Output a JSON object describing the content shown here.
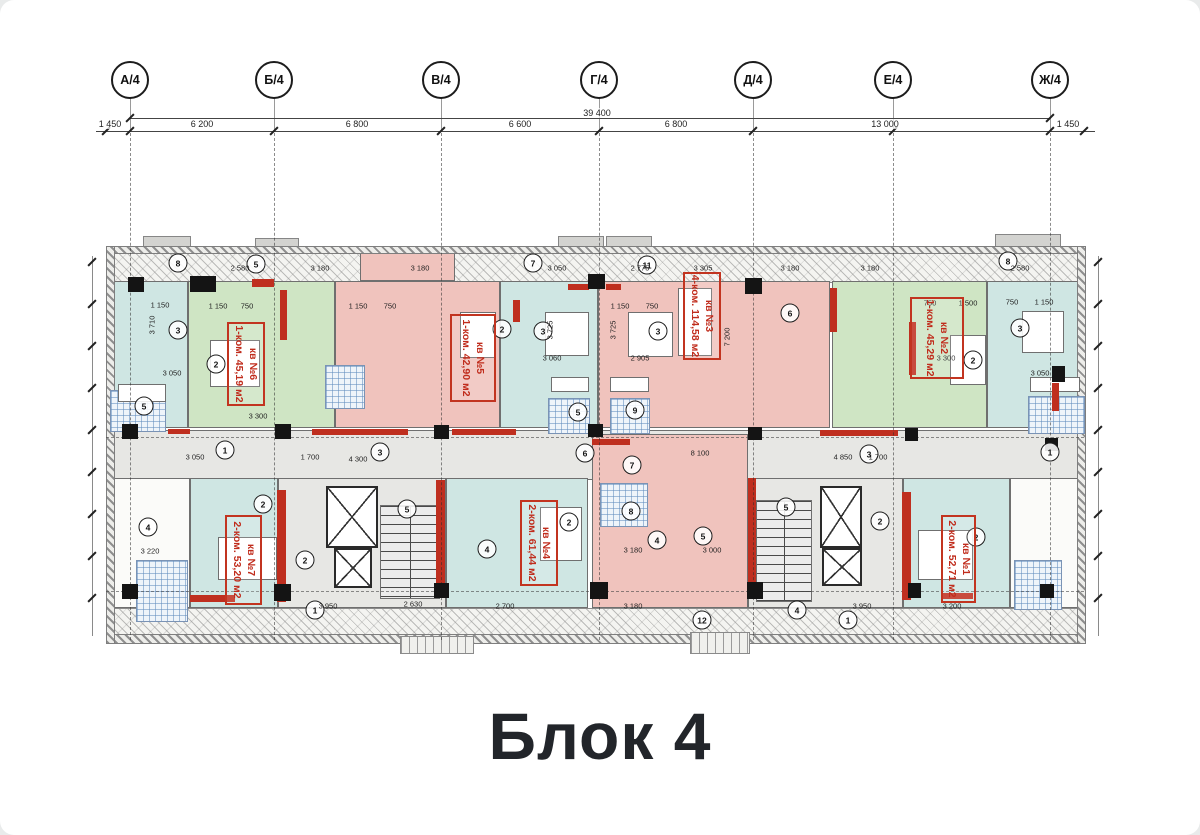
{
  "title": {
    "text": "Блок 4"
  },
  "palette": {
    "green": "#cfe5c4",
    "pink": "#f0c3bd",
    "cyan": "#cfe6e3",
    "gray": "#e7e7e4",
    "white": "#fbfbf9",
    "red": "#bf2f1f",
    "black": "#141414"
  },
  "axes": {
    "circle_y": 80,
    "line_top": 98,
    "line_bottom": 640,
    "items": [
      {
        "label": "А/4",
        "x": 130
      },
      {
        "label": "Б/4",
        "x": 274
      },
      {
        "label": "В/4",
        "x": 441
      },
      {
        "label": "Г/4",
        "x": 599
      },
      {
        "label": "Д/4",
        "x": 753
      },
      {
        "label": "Е/4",
        "x": 893
      },
      {
        "label": "Ж/4",
        "x": 1050
      }
    ]
  },
  "dimensions": {
    "total": {
      "label": "39 400",
      "x": 597,
      "y": 112,
      "x1": 130,
      "x2": 1050,
      "line_y": 118
    },
    "row_y": 131,
    "row_x1": 96,
    "row_x2": 1095,
    "ticks": [
      106,
      130,
      274,
      441,
      599,
      753,
      893,
      1050,
      1084
    ],
    "labels": [
      {
        "text": "1 450",
        "x": 110
      },
      {
        "text": "6 200",
        "x": 202
      },
      {
        "text": "6 800",
        "x": 357
      },
      {
        "text": "6 600",
        "x": 520
      },
      {
        "text": "6 800",
        "x": 676
      },
      {
        "text": "13 000",
        "x": 885
      },
      {
        "text": "1 450",
        "x": 1068
      }
    ]
  },
  "plan": {
    "walls": [
      {
        "x": 106,
        "y": 246,
        "w": 978,
        "h": 6
      },
      {
        "x": 106,
        "y": 634,
        "w": 978,
        "h": 8
      },
      {
        "x": 106,
        "y": 246,
        "w": 7,
        "h": 396
      },
      {
        "x": 1077,
        "y": 246,
        "w": 7,
        "h": 396
      }
    ],
    "strips": [
      {
        "x": 112,
        "y": 250,
        "w": 966,
        "h": 31
      },
      {
        "x": 112,
        "y": 608,
        "w": 966,
        "h": 28
      }
    ],
    "protrusions": [
      {
        "x": 143,
        "y": 236,
        "w": 46,
        "h": 11
      },
      {
        "x": 255,
        "y": 238,
        "w": 42,
        "h": 9
      },
      {
        "x": 558,
        "y": 236,
        "w": 44,
        "h": 11
      },
      {
        "x": 606,
        "y": 236,
        "w": 44,
        "h": 11
      },
      {
        "x": 995,
        "y": 234,
        "w": 64,
        "h": 13
      }
    ],
    "corridor": {
      "x": 112,
      "y": 430,
      "w": 966,
      "h": 50
    },
    "regions": [
      {
        "name": "room-end-left",
        "color": "cyan",
        "x": 112,
        "y": 281,
        "w": 76,
        "h": 147
      },
      {
        "name": "apt-6-area",
        "color": "green",
        "x": 188,
        "y": 281,
        "w": 147,
        "h": 147
      },
      {
        "name": "apt-5-balcony",
        "color": "pink",
        "x": 360,
        "y": 252,
        "w": 95,
        "h": 29
      },
      {
        "name": "apt-5-area",
        "color": "pink",
        "x": 335,
        "y": 281,
        "w": 165,
        "h": 147
      },
      {
        "name": "room-mid-cyan",
        "color": "cyan",
        "x": 500,
        "y": 281,
        "w": 98,
        "h": 147
      },
      {
        "name": "apt-3-area",
        "color": "pink",
        "x": 598,
        "y": 281,
        "w": 232,
        "h": 147
      },
      {
        "name": "apt-2-area",
        "color": "green",
        "x": 832,
        "y": 281,
        "w": 155,
        "h": 147
      },
      {
        "name": "room-end-right",
        "color": "cyan",
        "x": 987,
        "y": 281,
        "w": 97,
        "h": 147
      },
      {
        "name": "room-left-bottom",
        "color": "white",
        "x": 112,
        "y": 478,
        "w": 78,
        "h": 130
      },
      {
        "name": "apt-7-area",
        "color": "cyan",
        "x": 190,
        "y": 478,
        "w": 88,
        "h": 130
      },
      {
        "name": "core-left",
        "color": "gray",
        "x": 278,
        "y": 478,
        "w": 168,
        "h": 130
      },
      {
        "name": "apt-4-area",
        "color": "cyan",
        "x": 446,
        "y": 478,
        "w": 142,
        "h": 130
      },
      {
        "name": "apt-3-lower-area",
        "color": "pink",
        "x": 592,
        "y": 434,
        "w": 156,
        "h": 174
      },
      {
        "name": "core-right",
        "color": "gray",
        "x": 748,
        "y": 478,
        "w": 155,
        "h": 130
      },
      {
        "name": "apt-1-area",
        "color": "cyan",
        "x": 903,
        "y": 478,
        "w": 107,
        "h": 130
      },
      {
        "name": "room-right-bottom",
        "color": "white",
        "x": 1010,
        "y": 478,
        "w": 74,
        "h": 130
      }
    ],
    "bath_tiles": [
      {
        "x": 110,
        "y": 390,
        "w": 54,
        "h": 40
      },
      {
        "x": 325,
        "y": 365,
        "w": 38,
        "h": 42
      },
      {
        "x": 548,
        "y": 398,
        "w": 40,
        "h": 34
      },
      {
        "x": 610,
        "y": 398,
        "w": 38,
        "h": 34
      },
      {
        "x": 1028,
        "y": 396,
        "w": 55,
        "h": 36
      },
      {
        "x": 600,
        "y": 483,
        "w": 46,
        "h": 42
      },
      {
        "x": 136,
        "y": 560,
        "w": 50,
        "h": 60
      },
      {
        "x": 1014,
        "y": 560,
        "w": 46,
        "h": 48
      }
    ],
    "elevators": [
      {
        "x": 326,
        "y": 486,
        "w": 48,
        "h": 58
      },
      {
        "x": 334,
        "y": 548,
        "w": 34,
        "h": 36
      },
      {
        "x": 820,
        "y": 486,
        "w": 38,
        "h": 58
      },
      {
        "x": 822,
        "y": 548,
        "w": 36,
        "h": 34
      }
    ],
    "stairs": [
      {
        "x": 380,
        "y": 505,
        "w": 58,
        "h": 92
      },
      {
        "x": 756,
        "y": 500,
        "w": 54,
        "h": 100
      }
    ],
    "columns": [
      [
        190,
        276,
        26,
        16
      ],
      [
        128,
        277,
        16,
        15
      ],
      [
        588,
        274,
        17,
        15
      ],
      [
        745,
        278,
        17,
        16
      ],
      [
        1052,
        366,
        13,
        16
      ],
      [
        122,
        424,
        16,
        15
      ],
      [
        275,
        424,
        16,
        15
      ],
      [
        434,
        425,
        15,
        14
      ],
      [
        588,
        424,
        15,
        13
      ],
      [
        748,
        427,
        14,
        13
      ],
      [
        905,
        428,
        13,
        13
      ],
      [
        1045,
        438,
        13,
        13
      ],
      [
        122,
        584,
        16,
        15
      ],
      [
        274,
        584,
        17,
        17
      ],
      [
        434,
        583,
        15,
        15
      ],
      [
        590,
        582,
        18,
        17
      ],
      [
        747,
        582,
        16,
        17
      ],
      [
        908,
        583,
        13,
        15
      ],
      [
        1040,
        584,
        14,
        14
      ]
    ],
    "red_walls": [
      [
        252,
        279,
        22,
        8
      ],
      [
        568,
        284,
        21,
        6
      ],
      [
        606,
        284,
        15,
        6
      ],
      [
        830,
        288,
        7,
        44
      ],
      [
        513,
        300,
        7,
        22
      ],
      [
        280,
        290,
        7,
        50
      ],
      [
        909,
        322,
        7,
        53
      ],
      [
        168,
        429,
        22,
        5
      ],
      [
        312,
        429,
        96,
        6
      ],
      [
        452,
        429,
        64,
        6
      ],
      [
        820,
        430,
        78,
        6
      ],
      [
        592,
        439,
        38,
        6
      ],
      [
        436,
        480,
        9,
        103
      ],
      [
        748,
        478,
        8,
        109
      ],
      [
        277,
        490,
        9,
        112
      ],
      [
        902,
        492,
        9,
        108
      ],
      [
        1052,
        383,
        7,
        28
      ],
      [
        190,
        595,
        45,
        7
      ],
      [
        941,
        593,
        32,
        6
      ]
    ],
    "circles": [
      {
        "n": "8",
        "x": 178,
        "y": 263
      },
      {
        "n": "5",
        "x": 256,
        "y": 264
      },
      {
        "n": "7",
        "x": 533,
        "y": 263
      },
      {
        "n": "11",
        "x": 647,
        "y": 265
      },
      {
        "n": "8",
        "x": 1008,
        "y": 261
      },
      {
        "n": "3",
        "x": 178,
        "y": 330
      },
      {
        "n": "2",
        "x": 216,
        "y": 364
      },
      {
        "n": "2",
        "x": 502,
        "y": 329
      },
      {
        "n": "3",
        "x": 543,
        "y": 331
      },
      {
        "n": "3",
        "x": 658,
        "y": 331
      },
      {
        "n": "6",
        "x": 790,
        "y": 313
      },
      {
        "n": "2",
        "x": 973,
        "y": 360
      },
      {
        "n": "3",
        "x": 1020,
        "y": 328
      },
      {
        "n": "5",
        "x": 144,
        "y": 406
      },
      {
        "n": "5",
        "x": 578,
        "y": 412
      },
      {
        "n": "9",
        "x": 635,
        "y": 410
      },
      {
        "n": "1",
        "x": 225,
        "y": 450
      },
      {
        "n": "3",
        "x": 380,
        "y": 452
      },
      {
        "n": "6",
        "x": 585,
        "y": 453
      },
      {
        "n": "7",
        "x": 632,
        "y": 465
      },
      {
        "n": "3",
        "x": 869,
        "y": 454
      },
      {
        "n": "1",
        "x": 1050,
        "y": 452
      },
      {
        "n": "2",
        "x": 263,
        "y": 504
      },
      {
        "n": "4",
        "x": 148,
        "y": 527
      },
      {
        "n": "5",
        "x": 407,
        "y": 509
      },
      {
        "n": "2",
        "x": 305,
        "y": 560
      },
      {
        "n": "1",
        "x": 315,
        "y": 610
      },
      {
        "n": "4",
        "x": 487,
        "y": 549
      },
      {
        "n": "2",
        "x": 569,
        "y": 522
      },
      {
        "n": "8",
        "x": 631,
        "y": 511
      },
      {
        "n": "4",
        "x": 657,
        "y": 540
      },
      {
        "n": "5",
        "x": 703,
        "y": 536
      },
      {
        "n": "12",
        "x": 702,
        "y": 620
      },
      {
        "n": "5",
        "x": 786,
        "y": 507
      },
      {
        "n": "4",
        "x": 797,
        "y": 610
      },
      {
        "n": "1",
        "x": 848,
        "y": 620
      },
      {
        "n": "2",
        "x": 880,
        "y": 521
      },
      {
        "n": "2",
        "x": 976,
        "y": 537
      }
    ],
    "dims": [
      {
        "t": "2 580",
        "x": 240,
        "y": 268
      },
      {
        "t": "3 180",
        "x": 320,
        "y": 268
      },
      {
        "t": "3 180",
        "x": 420,
        "y": 268
      },
      {
        "t": "3 050",
        "x": 557,
        "y": 268
      },
      {
        "t": "2 775",
        "x": 640,
        "y": 268
      },
      {
        "t": "3 305",
        "x": 703,
        "y": 268
      },
      {
        "t": "3 180",
        "x": 790,
        "y": 268
      },
      {
        "t": "3 180",
        "x": 870,
        "y": 268
      },
      {
        "t": "2 580",
        "x": 1020,
        "y": 268
      },
      {
        "t": "1 150",
        "x": 160,
        "y": 305
      },
      {
        "t": "1 150",
        "x": 218,
        "y": 306
      },
      {
        "t": "750",
        "x": 247,
        "y": 306
      },
      {
        "t": "1 150",
        "x": 358,
        "y": 306
      },
      {
        "t": "750",
        "x": 390,
        "y": 306
      },
      {
        "t": "1 150",
        "x": 620,
        "y": 306
      },
      {
        "t": "750",
        "x": 652,
        "y": 306
      },
      {
        "t": "750",
        "x": 930,
        "y": 303
      },
      {
        "t": "1 500",
        "x": 968,
        "y": 303
      },
      {
        "t": "750",
        "x": 1012,
        "y": 302
      },
      {
        "t": "1 150",
        "x": 1044,
        "y": 302
      },
      {
        "t": "3 050",
        "x": 172,
        "y": 373
      },
      {
        "t": "3 300",
        "x": 258,
        "y": 416
      },
      {
        "t": "3 060",
        "x": 552,
        "y": 358
      },
      {
        "t": "2 905",
        "x": 640,
        "y": 358
      },
      {
        "t": "3 300",
        "x": 946,
        "y": 358
      },
      {
        "t": "3 050",
        "x": 1040,
        "y": 373
      },
      {
        "t": "3 725",
        "x": 550,
        "y": 330,
        "v": true
      },
      {
        "t": "3 725",
        "x": 613,
        "y": 330,
        "v": true
      },
      {
        "t": "7 200",
        "x": 727,
        "y": 337,
        "v": true
      },
      {
        "t": "3 710",
        "x": 152,
        "y": 325,
        "v": true
      },
      {
        "t": "4 300",
        "x": 358,
        "y": 459
      },
      {
        "t": "8 100",
        "x": 700,
        "y": 453
      },
      {
        "t": "4 850",
        "x": 843,
        "y": 457
      },
      {
        "t": "3 050",
        "x": 195,
        "y": 457
      },
      {
        "t": "1 700",
        "x": 310,
        "y": 457
      },
      {
        "t": "1 700",
        "x": 878,
        "y": 457
      },
      {
        "t": "3 180",
        "x": 633,
        "y": 550
      },
      {
        "t": "3 000",
        "x": 712,
        "y": 550
      },
      {
        "t": "3 220",
        "x": 150,
        "y": 551
      },
      {
        "t": "3 950",
        "x": 328,
        "y": 606
      },
      {
        "t": "2 630",
        "x": 413,
        "y": 604
      },
      {
        "t": "2 700",
        "x": 505,
        "y": 606
      },
      {
        "t": "3 180",
        "x": 633,
        "y": 606
      },
      {
        "t": "3 950",
        "x": 862,
        "y": 606
      },
      {
        "t": "3 200",
        "x": 952,
        "y": 606
      }
    ],
    "furniture": [
      {
        "x": 210,
        "y": 340,
        "w": 48,
        "h": 45
      },
      {
        "x": 460,
        "y": 312,
        "w": 34,
        "h": 44
      },
      {
        "x": 545,
        "y": 312,
        "w": 42,
        "h": 42
      },
      {
        "x": 628,
        "y": 312,
        "w": 43,
        "h": 43
      },
      {
        "x": 678,
        "y": 288,
        "w": 32,
        "h": 66
      },
      {
        "x": 950,
        "y": 335,
        "w": 34,
        "h": 48
      },
      {
        "x": 1022,
        "y": 311,
        "w": 40,
        "h": 40
      },
      {
        "x": 218,
        "y": 537,
        "w": 57,
        "h": 41
      },
      {
        "x": 540,
        "y": 507,
        "w": 40,
        "h": 52
      },
      {
        "x": 918,
        "y": 530,
        "w": 53,
        "h": 48
      },
      {
        "x": 118,
        "y": 384,
        "w": 46,
        "h": 16
      },
      {
        "x": 551,
        "y": 377,
        "w": 36,
        "h": 13
      },
      {
        "x": 610,
        "y": 377,
        "w": 37,
        "h": 13
      },
      {
        "x": 1030,
        "y": 377,
        "w": 48,
        "h": 13
      }
    ],
    "porches": [
      {
        "x": 400,
        "y": 636,
        "w": 72,
        "h": 16
      },
      {
        "x": 690,
        "y": 632,
        "w": 58,
        "h": 20
      }
    ],
    "center_dash": [
      {
        "x": 106,
        "y": 437,
        "w": 978
      },
      {
        "x": 106,
        "y": 591,
        "w": 978
      }
    ],
    "edge_chains": [
      {
        "x": 92,
        "y1": 256,
        "y2": 636
      },
      {
        "x": 1098,
        "y1": 256,
        "y2": 636
      }
    ]
  },
  "apartments": [
    {
      "id": "apt-6",
      "line1": "кв №6",
      "line2": "1-ком. 45,19 м2",
      "x": 227,
      "y": 322,
      "w": 34,
      "h": 80
    },
    {
      "id": "apt-5",
      "line1": "кв №5",
      "line2": "1-ком. 42,90 м2",
      "x": 450,
      "y": 314,
      "w": 42,
      "h": 84
    },
    {
      "id": "apt-3",
      "line1": "кв №3",
      "line2": "4-ком. 114,58 м2",
      "x": 683,
      "y": 272,
      "w": 34,
      "h": 84
    },
    {
      "id": "apt-2",
      "line1": "кв №2",
      "line2": "1-ком. 45,29 м2",
      "x": 910,
      "y": 297,
      "w": 50,
      "h": 78
    },
    {
      "id": "apt-7",
      "line1": "кв №7",
      "line2": "2-ком. 53,20 м2",
      "x": 225,
      "y": 515,
      "w": 33,
      "h": 86
    },
    {
      "id": "apt-4",
      "line1": "кв №4",
      "line2": "2-ком. 61,44 м2",
      "x": 520,
      "y": 500,
      "w": 34,
      "h": 82
    },
    {
      "id": "apt-1",
      "line1": "кв №1",
      "line2": "2-ком. 52,71 м2",
      "x": 941,
      "y": 515,
      "w": 31,
      "h": 84
    }
  ]
}
